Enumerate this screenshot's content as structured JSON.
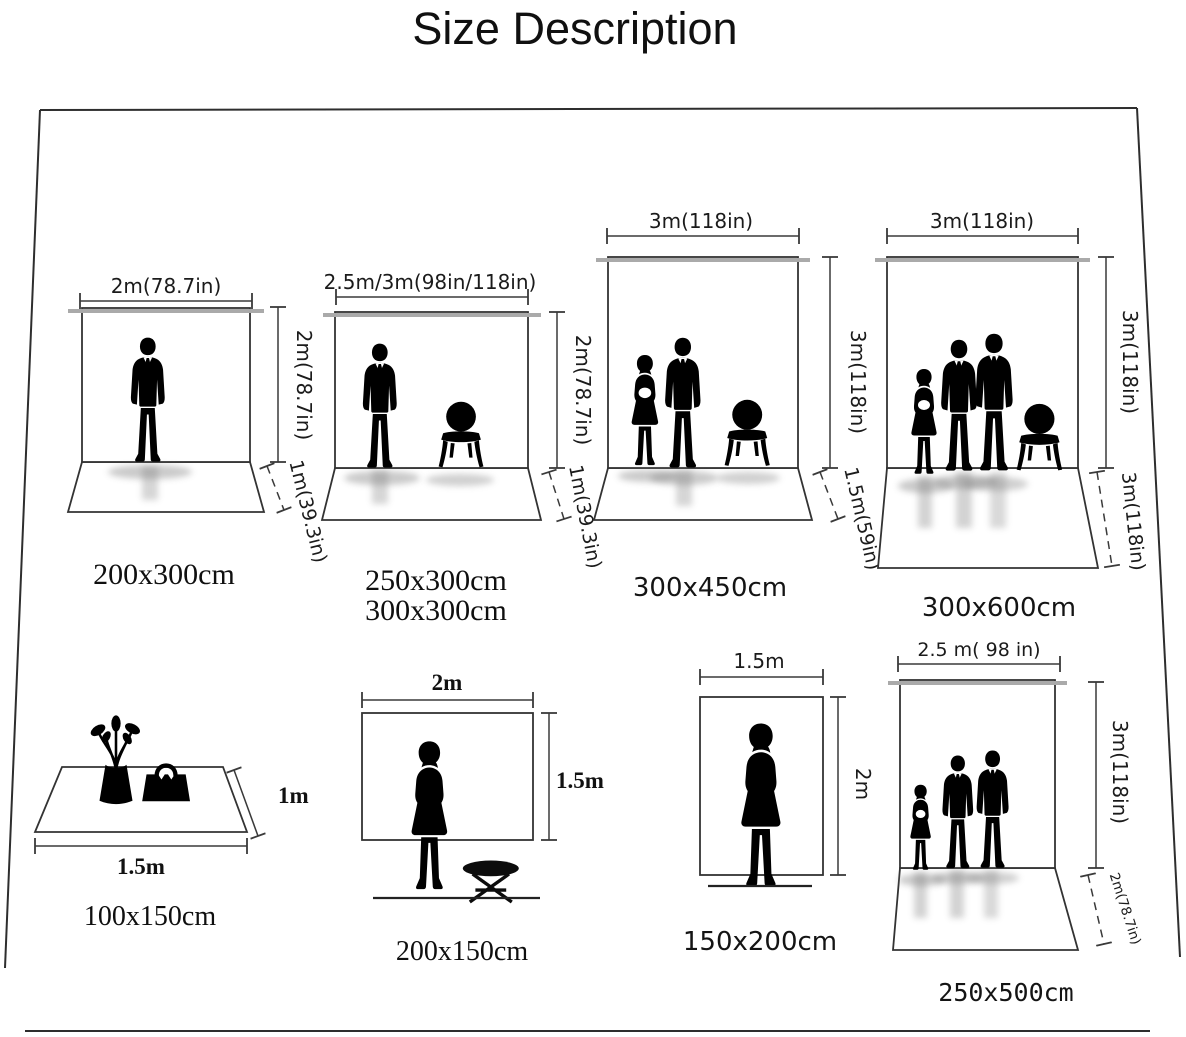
{
  "title": "Size Description",
  "colors": {
    "background": "#ffffff",
    "ink": "#111111",
    "rod_gray": "#aaaaaa",
    "line": "#3a3a3a"
  },
  "panels": [
    {
      "size_labels": [
        "200x300cm"
      ],
      "width_label": "2m(78.7in)",
      "height_label": "2m(78.7in)",
      "floor_label": "1m(39.3in)",
      "figures": [
        "man-silhouette"
      ]
    },
    {
      "size_labels": [
        "250x300cm",
        "300x300cm"
      ],
      "width_label": "2.5m/3m(98in/118in)",
      "height_label": "2m(78.7in)",
      "floor_label": "1m(39.3in)",
      "figures": [
        "man-silhouette",
        "chair-silhouette"
      ]
    },
    {
      "size_labels": [
        "300x450cm"
      ],
      "width_label": "3m(118in)",
      "height_label": "3m(118in)",
      "floor_label": "1.5m(59in)",
      "figures": [
        "woman-silhouette",
        "man-silhouette",
        "chair-silhouette"
      ]
    },
    {
      "size_labels": [
        "300x600cm"
      ],
      "width_label": "3m(118in)",
      "height_label": "3m(118in)",
      "floor_label": "3m(118in)",
      "figures": [
        "woman-silhouette",
        "man-silhouette",
        "man-silhouette",
        "chair-silhouette"
      ]
    },
    {
      "size_labels": [
        "100x150cm"
      ],
      "width_label": "1.5m",
      "height_label": "1m",
      "figures": [
        "vase-flowers-silhouette",
        "handbag-silhouette"
      ]
    },
    {
      "size_labels": [
        "200x150cm"
      ],
      "width_label": "2m",
      "height_label": "1.5m",
      "figures": [
        "woman-silhouette",
        "stool-silhouette"
      ]
    },
    {
      "size_labels": [
        "150x200cm"
      ],
      "width_label": "1.5m",
      "height_label": "2m",
      "figures": [
        "woman-silhouette"
      ]
    },
    {
      "size_labels": [
        "250x500cm"
      ],
      "width_label": "2.5 m( 98 in)",
      "height_label": "3m(118in)",
      "floor_label": "2m(78.7in)",
      "figures": [
        "woman-silhouette",
        "man-silhouette",
        "man-silhouette"
      ]
    }
  ]
}
